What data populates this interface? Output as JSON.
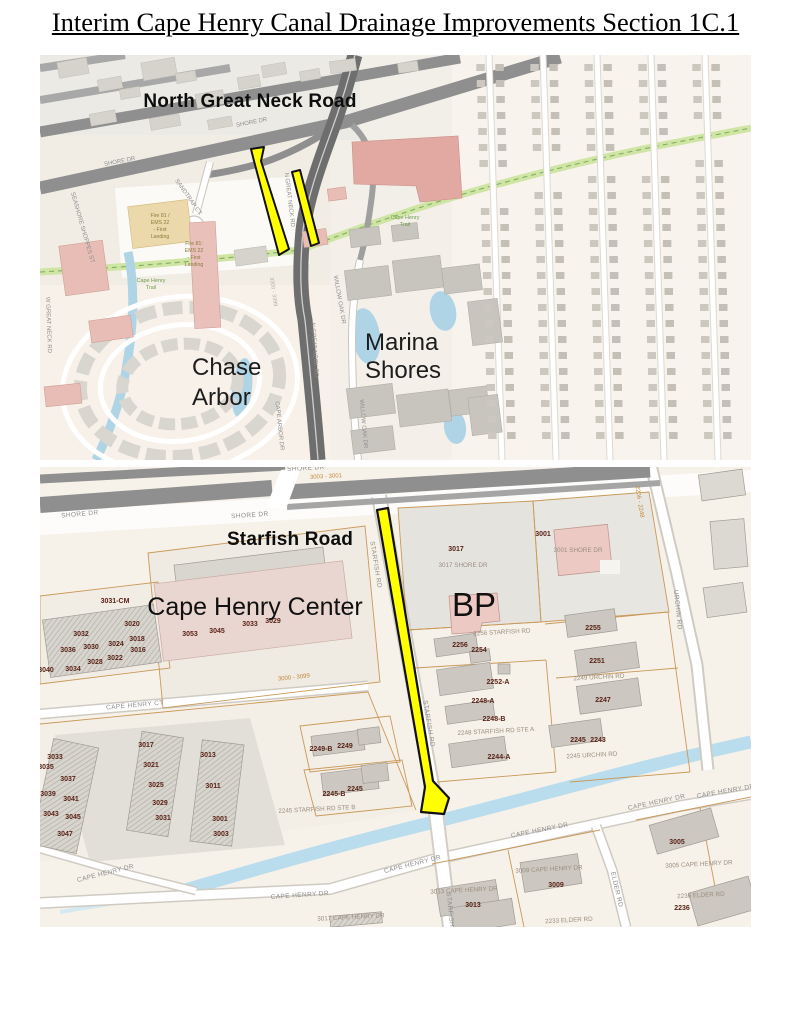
{
  "page": {
    "title": "Interim Cape Henry Canal Drainage Improvements Section 1C.1"
  },
  "colors": {
    "highlight": "#ffff00",
    "parcel_line": "#c9995a",
    "water": "#badded",
    "road_major": "#8f8f8f",
    "road_dark": "#6e6e6e",
    "trail_green": "#cfe5a4"
  },
  "map1": {
    "main_road_label": "North Great Neck Road",
    "neighborhood_chase_line1": "Chase",
    "neighborhood_chase_line2": "Arbor",
    "neighborhood_marina_line1": "Marina",
    "neighborhood_marina_line2": "Shores",
    "street_labels": [
      {
        "t": "SHORE DR",
        "x": 120,
        "y": 163,
        "r": -11
      },
      {
        "t": "SHORE DR",
        "x": 252,
        "y": 124,
        "r": -11
      },
      {
        "t": "N GREAT NECK RD",
        "x": 288,
        "y": 200,
        "r": 83
      },
      {
        "t": "N GREAT NECK RD",
        "x": 313,
        "y": 350,
        "r": 86
      },
      {
        "t": "WILLOW OAK DR",
        "x": 338,
        "y": 300,
        "r": 80
      },
      {
        "t": "WILLOW OAK DR",
        "x": 362,
        "y": 424,
        "r": 85
      },
      {
        "t": "CAPE ARBOR DR",
        "x": 278,
        "y": 426,
        "r": 84
      },
      {
        "t": "SANDTRAP CT",
        "x": 187,
        "y": 198,
        "r": 55
      },
      {
        "t": "SEASHORE SHOPPES ST",
        "x": 81,
        "y": 228,
        "r": 74
      },
      {
        "t": "W GREAT NECK RD",
        "x": 47,
        "y": 325,
        "r": 88
      }
    ],
    "faint_labels": [
      {
        "t": "3300 - 3399",
        "x": 272,
        "y": 292,
        "r": 82
      }
    ],
    "trail_labels": [
      {
        "t": "Cape Henry",
        "x": 151,
        "y": 282
      },
      {
        "t": "Trail",
        "x": 151,
        "y": 289
      },
      {
        "t": "Cape Henry",
        "x": 405,
        "y": 219
      },
      {
        "t": "Trail",
        "x": 405,
        "y": 226
      }
    ],
    "poi_labels": [
      {
        "t": "Fire 81 /",
        "x": 160,
        "y": 217
      },
      {
        "t": "EMS 22",
        "x": 160,
        "y": 224
      },
      {
        "t": "- First",
        "x": 160,
        "y": 231
      },
      {
        "t": "Landing",
        "x": 160,
        "y": 238
      },
      {
        "t": "Fire 81:",
        "x": 194,
        "y": 245
      },
      {
        "t": "EMS 22",
        "x": 194,
        "y": 252
      },
      {
        "t": "- First",
        "x": 194,
        "y": 259
      },
      {
        "t": "Landing",
        "x": 194,
        "y": 266
      }
    ]
  },
  "map2": {
    "main_road_label": "Starfish Road",
    "center_label": "Cape Henry Center",
    "bp_label": "BP",
    "street_labels": [
      {
        "t": "SHORE DR",
        "x": 80,
        "y": 516,
        "r": -5
      },
      {
        "t": "SHORE DR",
        "x": 250,
        "y": 517,
        "r": -4
      },
      {
        "t": "SHORE DR",
        "x": 306,
        "y": 470,
        "r": -3
      },
      {
        "t": "STARFISH RD",
        "x": 374,
        "y": 565,
        "r": 81
      },
      {
        "t": "STARFISH RD",
        "x": 427,
        "y": 724,
        "r": 81
      },
      {
        "t": "STARFISH RD",
        "x": 449,
        "y": 916,
        "r": 84
      },
      {
        "t": "URCHIN RD",
        "x": 676,
        "y": 610,
        "r": 84
      },
      {
        "t": "ELDER RD",
        "x": 615,
        "y": 890,
        "r": 77
      },
      {
        "t": "CAPE HENRY CT",
        "x": 135,
        "y": 707,
        "r": -5
      },
      {
        "t": "CAPE HENRY DR",
        "x": 106,
        "y": 875,
        "r": -14
      },
      {
        "t": "CAPE HENRY DR",
        "x": 300,
        "y": 897,
        "r": -4
      },
      {
        "t": "CAPE HENRY DR",
        "x": 413,
        "y": 866,
        "r": -14
      },
      {
        "t": "CAPE HENRY DR",
        "x": 540,
        "y": 832,
        "r": -11
      },
      {
        "t": "CAPE HENRY DR",
        "x": 657,
        "y": 804,
        "r": -12
      },
      {
        "t": "CAPE HENRY DR",
        "x": 726,
        "y": 793,
        "r": -10
      }
    ],
    "block_range_labels": [
      {
        "t": "3003 - 3001",
        "x": 326,
        "y": 478,
        "r": -3
      },
      {
        "t": "2206 - 2248",
        "x": 638,
        "y": 502,
        "r": 81
      },
      {
        "t": "3000 - 3099",
        "x": 294,
        "y": 679,
        "r": -6
      }
    ],
    "address_labels": [
      {
        "t": "3017 SHORE DR",
        "x": 463,
        "y": 567,
        "r": 0
      },
      {
        "t": "3001 SHORE DR",
        "x": 578,
        "y": 552,
        "r": 0
      },
      {
        "t": "2256 STARFISH RD",
        "x": 502,
        "y": 634,
        "r": -3
      },
      {
        "t": "2249 URCHIN RD",
        "x": 599,
        "y": 679,
        "r": -3
      },
      {
        "t": "2248 STARFISH RD STE A",
        "x": 496,
        "y": 733,
        "r": -3
      },
      {
        "t": "2245 URCHIN RD",
        "x": 592,
        "y": 757,
        "r": -3
      },
      {
        "t": "2245 STARFISH RD STE B",
        "x": 317,
        "y": 811,
        "r": -3
      },
      {
        "t": "3005 CAPE HENRY DR",
        "x": 699,
        "y": 866,
        "r": -3
      },
      {
        "t": "3009 CAPE HENRY DR",
        "x": 549,
        "y": 871,
        "r": -3
      },
      {
        "t": "3013 CAPE HENRY DR",
        "x": 464,
        "y": 892,
        "r": -3
      },
      {
        "t": "3017 CAPE HENRY DR",
        "x": 351,
        "y": 919,
        "r": -3
      },
      {
        "t": "2233 ELDER RD",
        "x": 569,
        "y": 922,
        "r": -3
      },
      {
        "t": "2236 ELDER RD",
        "x": 701,
        "y": 897,
        "r": -3
      }
    ],
    "parcel_numbers": [
      {
        "t": "3017",
        "x": 456,
        "y": 551
      },
      {
        "t": "3001",
        "x": 543,
        "y": 536
      },
      {
        "t": "3031-CM",
        "x": 115,
        "y": 603
      },
      {
        "t": "3020",
        "x": 132,
        "y": 626
      },
      {
        "t": "3032",
        "x": 81,
        "y": 636
      },
      {
        "t": "3018",
        "x": 137,
        "y": 641
      },
      {
        "t": "3024",
        "x": 116,
        "y": 646
      },
      {
        "t": "3030",
        "x": 91,
        "y": 649
      },
      {
        "t": "3036",
        "x": 68,
        "y": 652
      },
      {
        "t": "3016",
        "x": 138,
        "y": 652
      },
      {
        "t": "3022",
        "x": 115,
        "y": 660
      },
      {
        "t": "3028",
        "x": 95,
        "y": 664
      },
      {
        "t": "3034",
        "x": 73,
        "y": 671
      },
      {
        "t": "3040",
        "x": 46,
        "y": 672
      },
      {
        "t": "3053",
        "x": 190,
        "y": 636
      },
      {
        "t": "3045",
        "x": 217,
        "y": 633
      },
      {
        "t": "3033",
        "x": 250,
        "y": 626
      },
      {
        "t": "3029",
        "x": 273,
        "y": 623
      },
      {
        "t": "2256",
        "x": 460,
        "y": 647
      },
      {
        "t": "2254",
        "x": 479,
        "y": 652
      },
      {
        "t": "2255",
        "x": 593,
        "y": 630
      },
      {
        "t": "2251",
        "x": 597,
        "y": 663
      },
      {
        "t": "2252-A",
        "x": 498,
        "y": 684
      },
      {
        "t": "2248-A",
        "x": 483,
        "y": 703
      },
      {
        "t": "2248-B",
        "x": 494,
        "y": 721
      },
      {
        "t": "2244-A",
        "x": 499,
        "y": 759
      },
      {
        "t": "2247",
        "x": 603,
        "y": 702
      },
      {
        "t": "2245",
        "x": 578,
        "y": 742
      },
      {
        "t": "2243",
        "x": 598,
        "y": 742
      },
      {
        "t": "2249-B",
        "x": 321,
        "y": 751
      },
      {
        "t": "2249",
        "x": 345,
        "y": 748
      },
      {
        "t": "2245-B",
        "x": 334,
        "y": 796
      },
      {
        "t": "2245",
        "x": 355,
        "y": 791
      },
      {
        "t": "3033",
        "x": 55,
        "y": 759
      },
      {
        "t": "3035",
        "x": 46,
        "y": 769
      },
      {
        "t": "3037",
        "x": 68,
        "y": 781
      },
      {
        "t": "3039",
        "x": 48,
        "y": 796
      },
      {
        "t": "3041",
        "x": 71,
        "y": 801
      },
      {
        "t": "3043",
        "x": 51,
        "y": 816
      },
      {
        "t": "3045",
        "x": 73,
        "y": 819
      },
      {
        "t": "3047",
        "x": 65,
        "y": 836
      },
      {
        "t": "3017",
        "x": 146,
        "y": 747
      },
      {
        "t": "3021",
        "x": 151,
        "y": 767
      },
      {
        "t": "3025",
        "x": 156,
        "y": 787
      },
      {
        "t": "3029",
        "x": 160,
        "y": 805
      },
      {
        "t": "3031",
        "x": 163,
        "y": 820
      },
      {
        "t": "3013",
        "x": 208,
        "y": 757
      },
      {
        "t": "3011",
        "x": 213,
        "y": 788
      },
      {
        "t": "3001",
        "x": 220,
        "y": 821
      },
      {
        "t": "3003",
        "x": 221,
        "y": 836
      },
      {
        "t": "3005",
        "x": 677,
        "y": 844
      },
      {
        "t": "3009",
        "x": 556,
        "y": 887
      },
      {
        "t": "3013",
        "x": 473,
        "y": 907
      },
      {
        "t": "2236",
        "x": 682,
        "y": 910
      }
    ]
  }
}
